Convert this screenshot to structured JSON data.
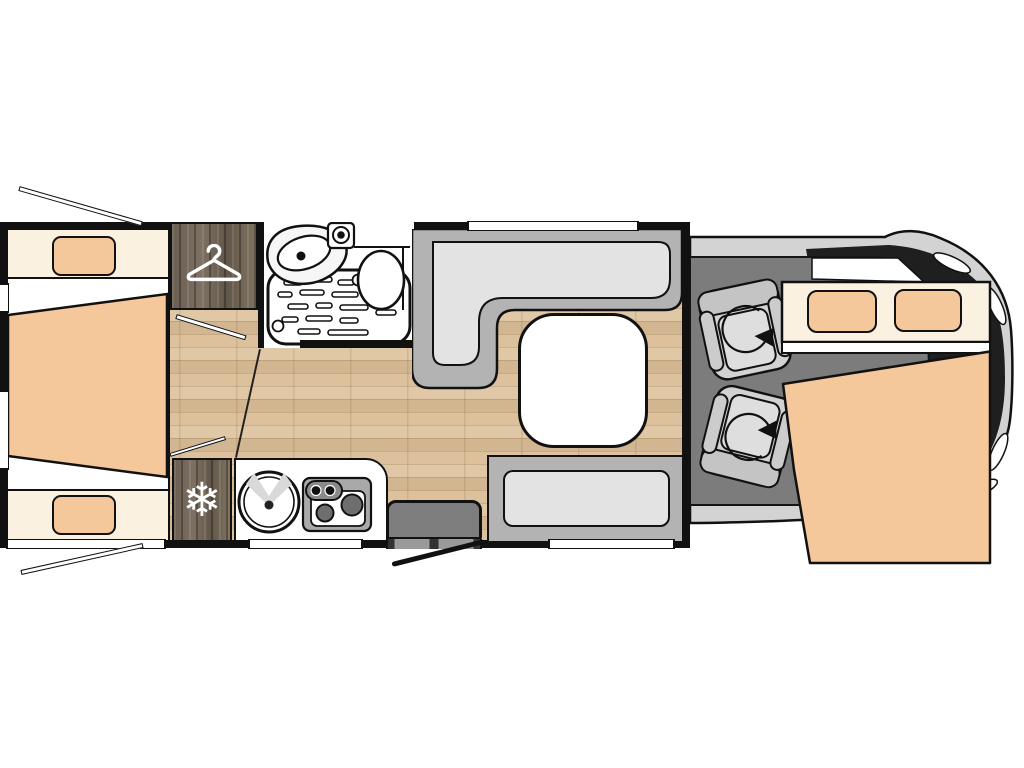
{
  "meta": {
    "title": "Motorhome floor plan (top view)",
    "view": "top-down floorplan diagram",
    "canvas": {
      "width": 1024,
      "height": 768
    },
    "background": "#ffffff",
    "visible_text": "none"
  },
  "colors": {
    "wall": "#111111",
    "floor-wood": "#dcc19c",
    "hall-seam": "#222222",
    "dark-wood": "#6b5f53",
    "bed-cream": "#fbf1e1",
    "bed-beige": "#f5c89b",
    "bench-frame": "#b3b3b3",
    "bench-cushion": "#e3e3e3",
    "cab-floor": "#7c7c7c",
    "cab-body": "#d3d3d3",
    "glass": "#1f1f1f",
    "step-gray": "#7e7e7e",
    "fixture-white": "#ffffff",
    "stove-gray": "#a9a9a9",
    "burner-gray": "#6e6e6e"
  },
  "vehicle": {
    "orientation": "cab on right, rear on left",
    "sections": {
      "rear_bedroom": {
        "label": "Rear bedroom: two single beds with central trapezoid mattress",
        "beds": 2,
        "pillows": 2
      },
      "wardrobe": {
        "label": "Wardrobe",
        "icon": "hanger-icon"
      },
      "bathroom": {
        "label": "Shower room",
        "fixtures": [
          "corner-vanity-sink",
          "faucet",
          "shower-tray",
          "toilet"
        ]
      },
      "fridge": {
        "label": "Refrigerator",
        "icon": "snowflake-icon"
      },
      "kitchen": {
        "label": "Kitchenette",
        "fixtures": [
          "round-sink",
          "two-burner-hob",
          "control-knobs"
        ]
      },
      "entrance": {
        "label": "Entry door with interior step",
        "door_swing": true
      },
      "dinette": {
        "label": "Dinette",
        "benches": [
          "l-shaped-bench",
          "front-bench"
        ],
        "table": "rounded-square-table"
      },
      "cab": {
        "label": "Driver cab",
        "swivel_seats": 2,
        "windshield": true
      },
      "overcab_bed": {
        "label": "Drop-down double bed over cab",
        "pillows": 2
      }
    },
    "openings": {
      "side_windows": 6,
      "open_window_flaps": 2,
      "entry_door_swing_lines": 1,
      "interior_door_leaves": 2
    }
  }
}
